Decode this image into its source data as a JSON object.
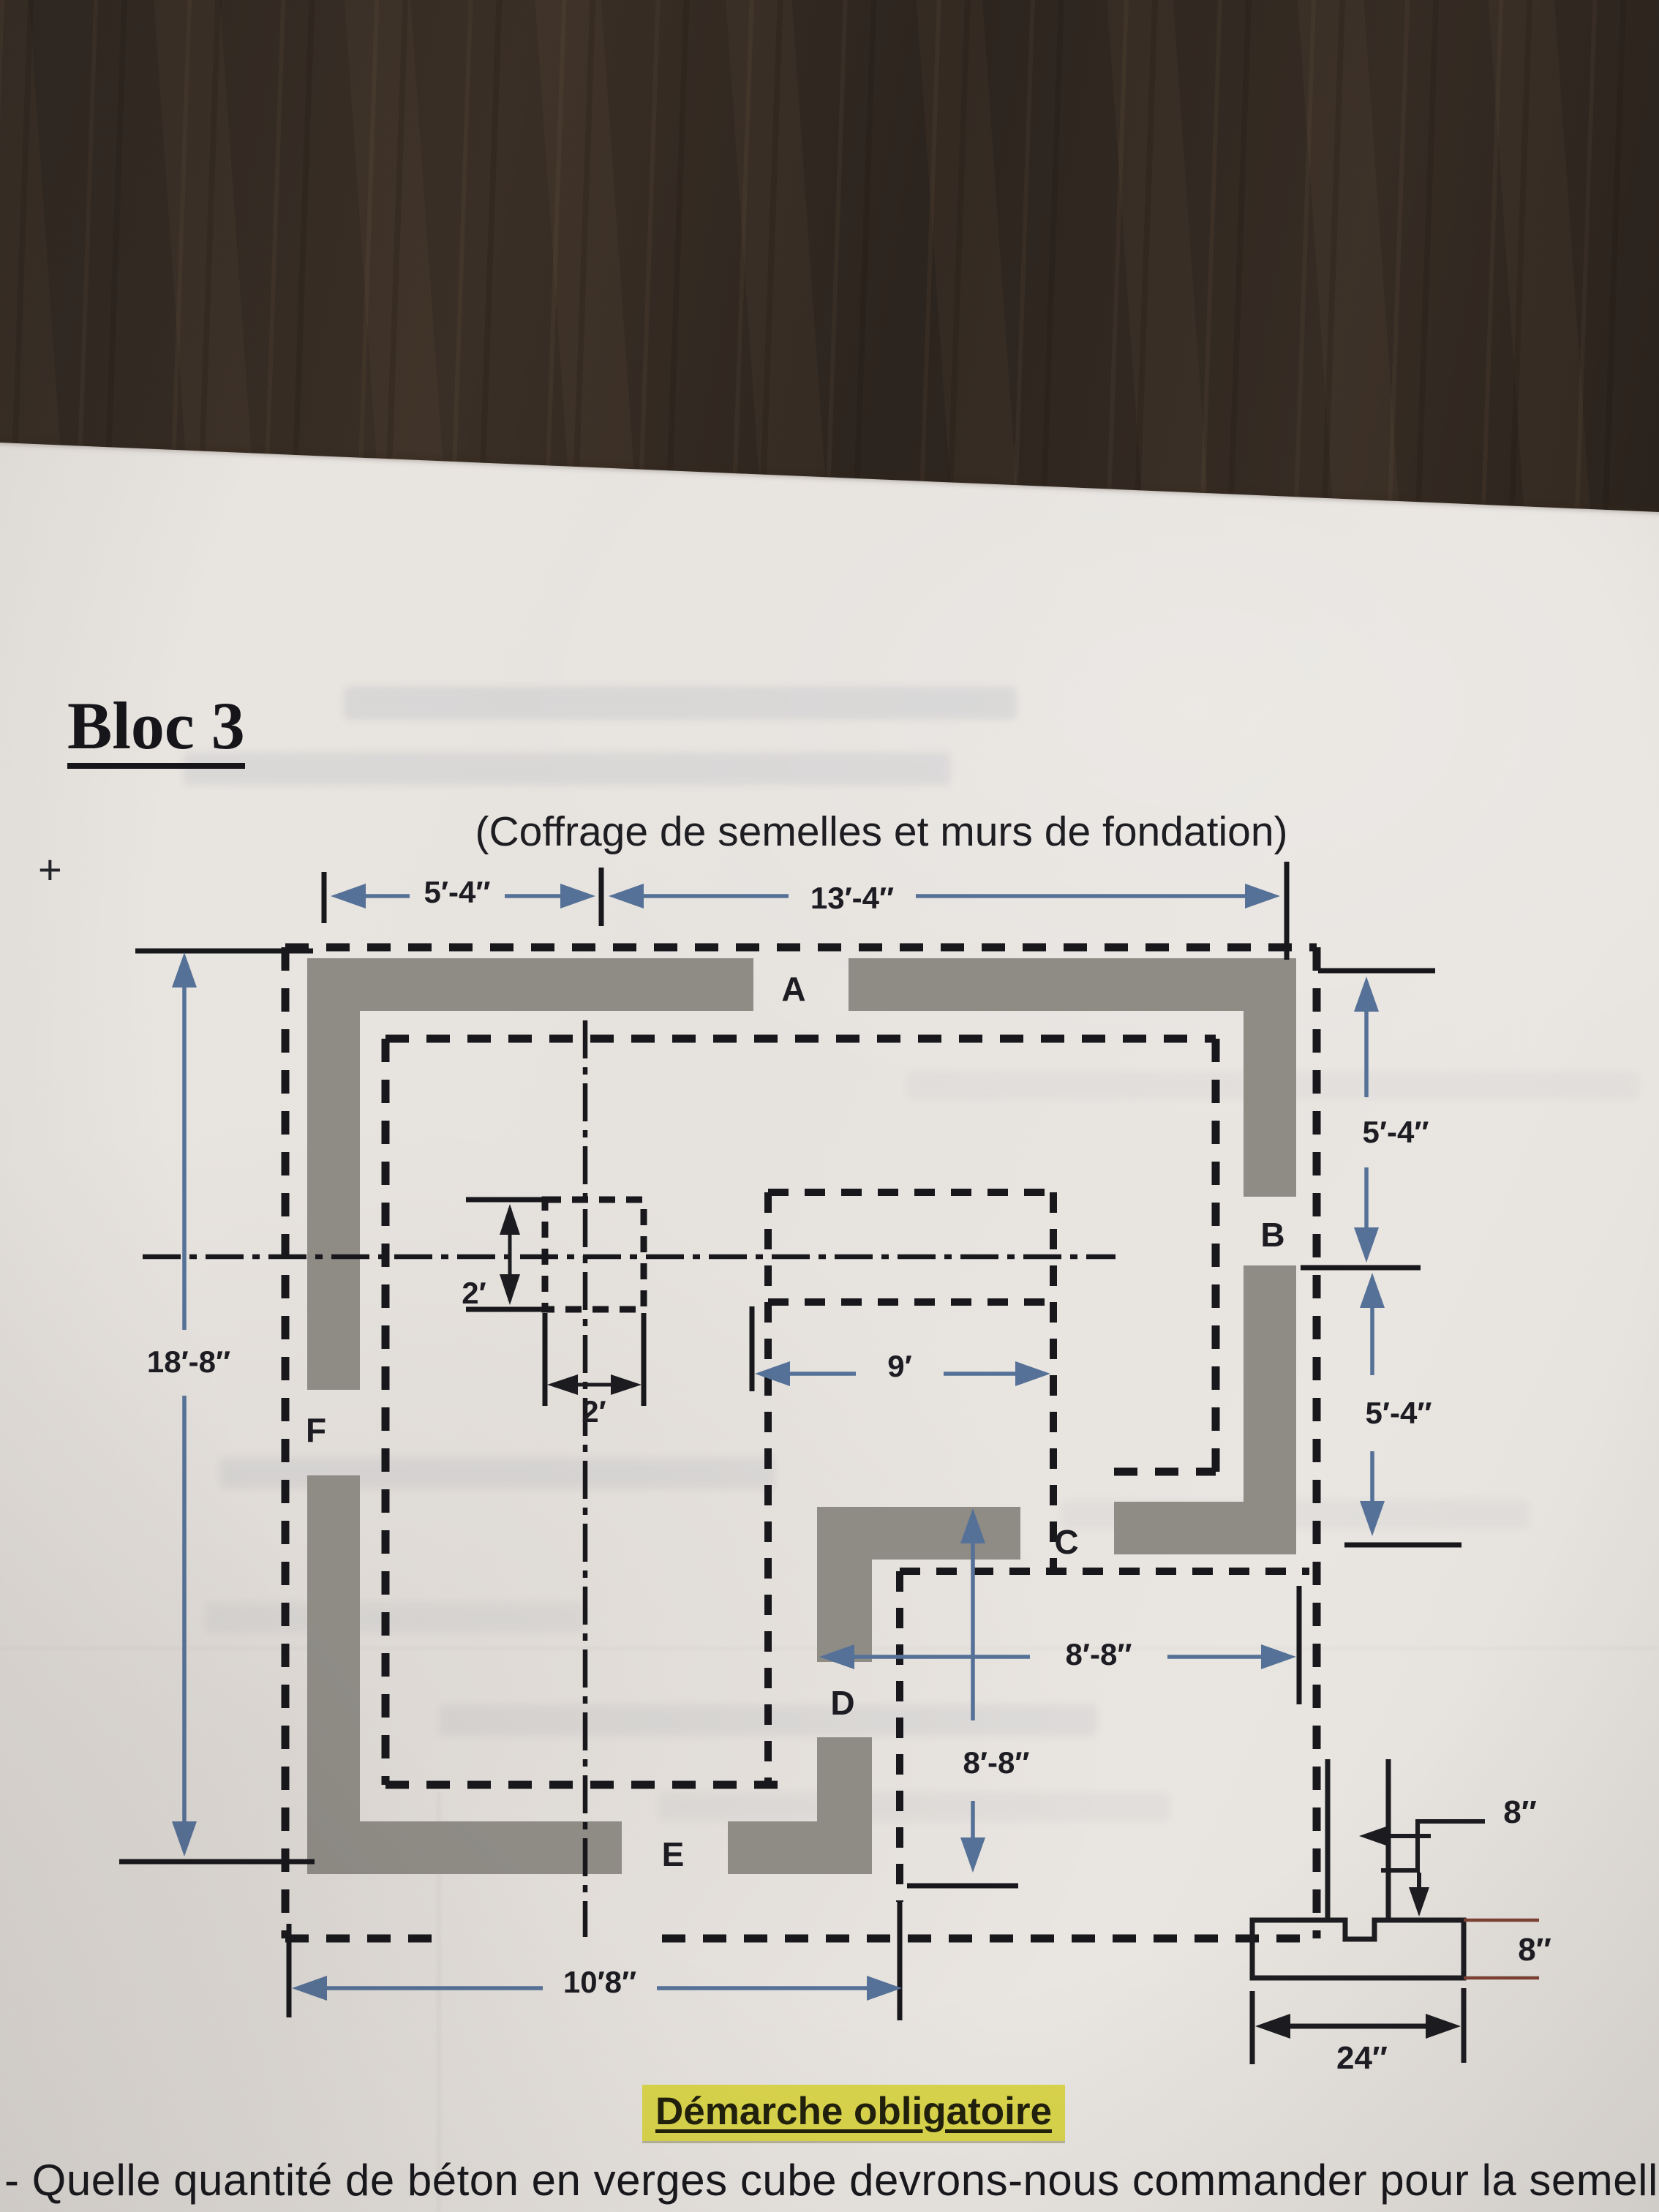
{
  "header": {
    "block_title": "Bloc 3",
    "subtitle": "(Coffrage de semelles et murs de fondation)"
  },
  "plan": {
    "plus_mark": "+",
    "room_labels": {
      "a": "A",
      "b": "B",
      "c": "C",
      "d": "D",
      "e": "E",
      "f": "F"
    },
    "dims": {
      "top_left": "5′-4″",
      "top_right": "13′-4″",
      "left": "18′-8″",
      "right_upper": "5′-4″",
      "right_lower": "5′-4″",
      "interior_width": "9′",
      "pier_height": "2′",
      "pier_width": "2′",
      "patio_width": "8′-8″",
      "patio_height": "8′-8″",
      "bottom": "10′8″"
    }
  },
  "section_detail": {
    "wall_thickness": "8″",
    "footing_height": "8″",
    "footing_width": "24″"
  },
  "footer": {
    "highlight": "Démarche obligatoire",
    "question": "- Quelle quantité de béton en verges cube devrons-nous commander pour la semelle de cet"
  },
  "colors": {
    "wall_gray": "#8f8c86",
    "dash_black": "#17171c",
    "dim_blue": "#567197",
    "section_red": "#7d4133",
    "highlight_yellow": "#d9d44b",
    "wood_brown": "#32291f",
    "paper": "#e8e4e0"
  }
}
